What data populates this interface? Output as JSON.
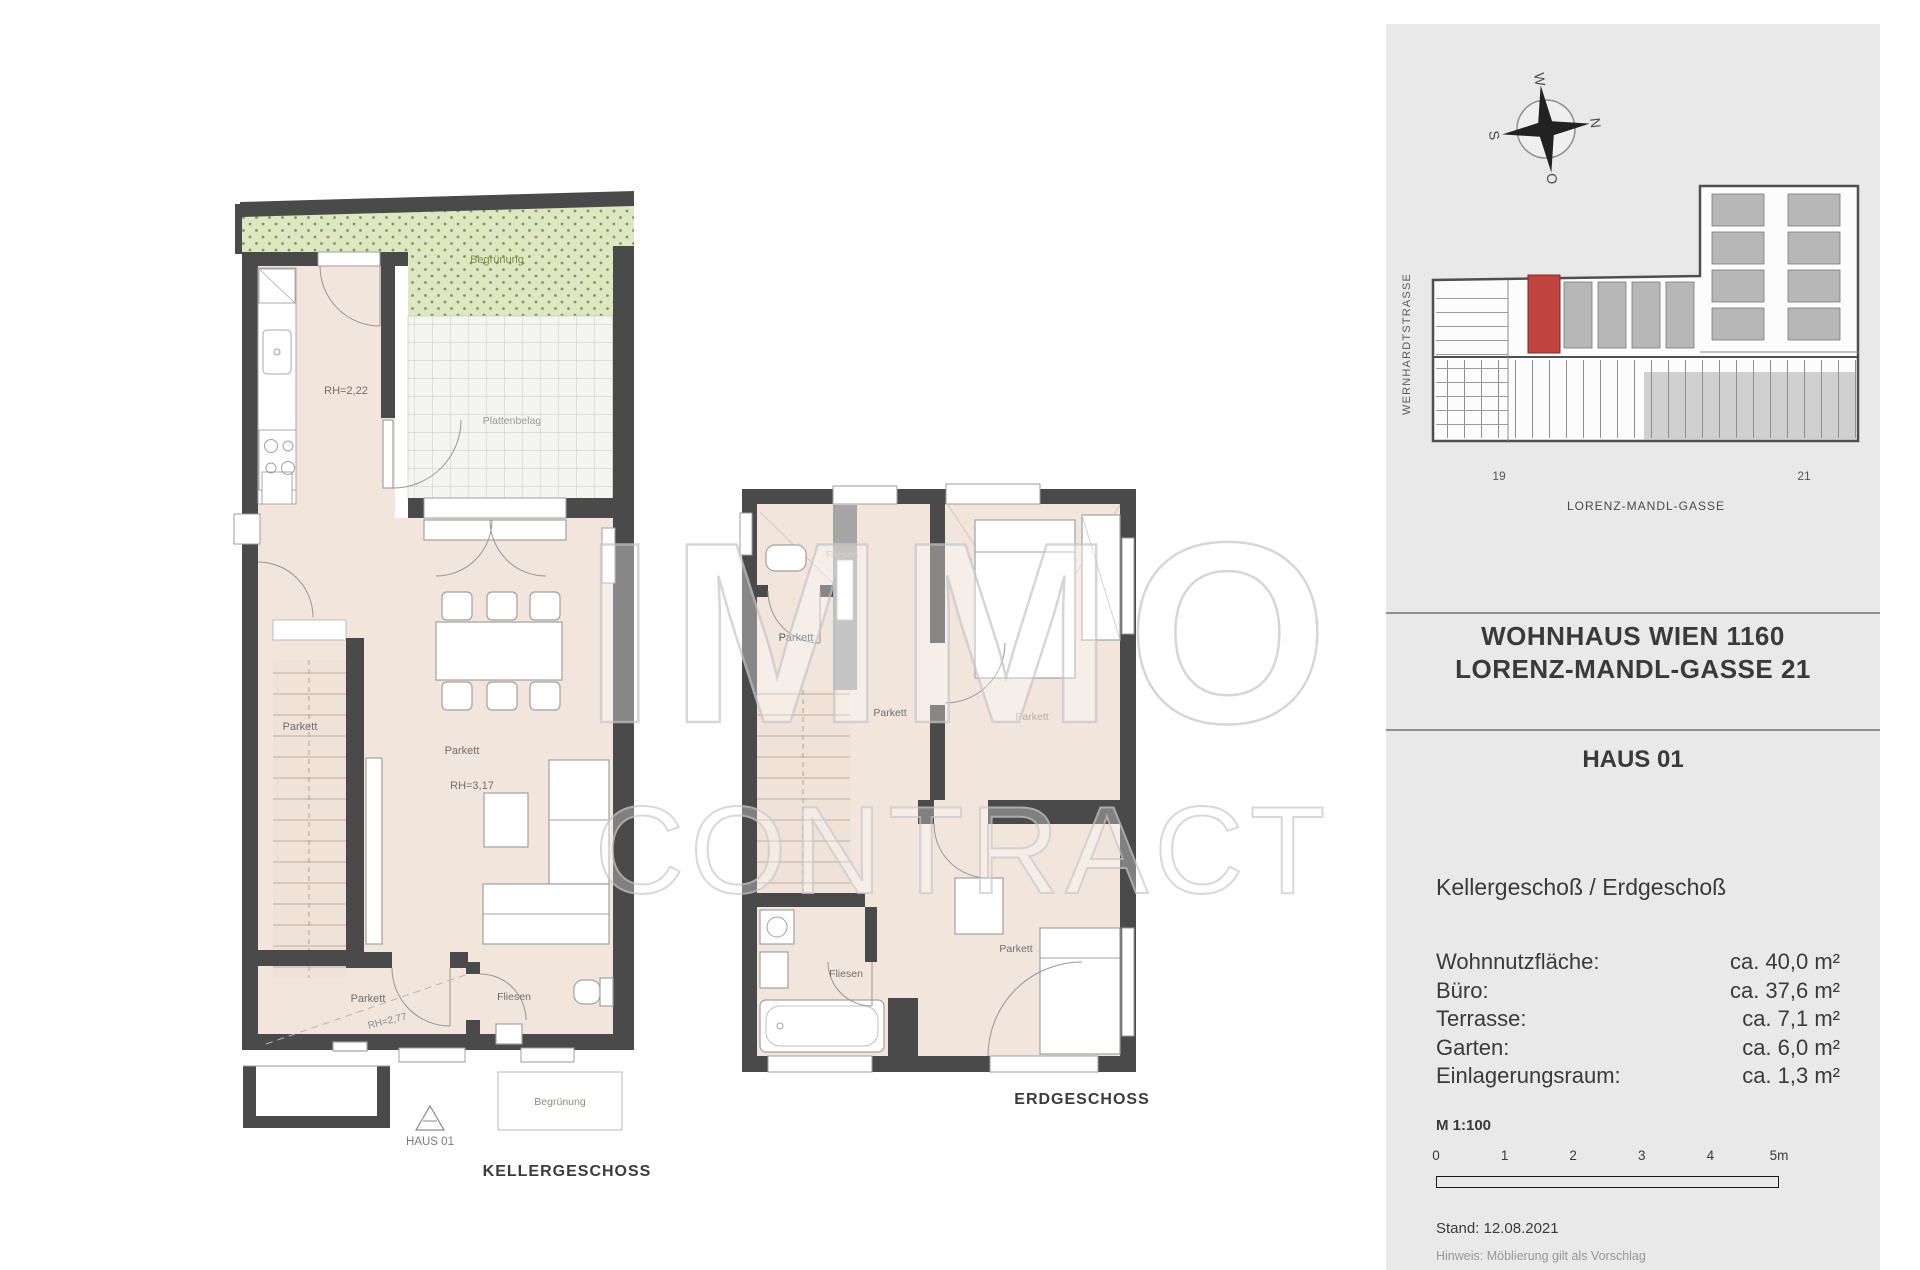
{
  "watermark": {
    "line1": "IMMO",
    "line2": "CONTRACT"
  },
  "plan_kg": {
    "caption": "KELLERGESCHOSS",
    "house_marker": "HAUS 01",
    "labels": {
      "begruenung_top": "Begrünung",
      "plattenbelag": "Plattenbelag",
      "rh_kitchen": "RH=2,22",
      "parkett_stairs": "Parkett",
      "parkett_living": "Parkett",
      "rh_living": "RH=3,17",
      "parkett_corridor": "Parkett",
      "rh_corridor": "RH=2,77",
      "fliesen_bath": "Fliesen",
      "begruenung_bottom": "Begrünung"
    }
  },
  "plan_eg": {
    "caption": "ERDGESCHOSS",
    "labels": {
      "fliesen_wc": "Fliesen",
      "parkett_hall": "Parkett",
      "parkett_corridor": "Parkett",
      "parkett_bedroom": "Parkett",
      "fliesen_bath": "Fliesen",
      "parkett_room2": "Parkett"
    }
  },
  "panel": {
    "compass": {
      "n": "N",
      "e": "O",
      "s": "S",
      "w": "W"
    },
    "siteplan": {
      "street_left": "WERNHARDTSTRASSE",
      "street_bottom": "LORENZ-MANDL-GASSE",
      "house_no_left": "19",
      "house_no_right": "21"
    },
    "title": {
      "line1": "WOHNHAUS WIEN 1160",
      "line2": "LORENZ-MANDL-GASSE 21"
    },
    "unit": "HAUS 01",
    "floors": "Kellergeschoß / Erdgeschoß",
    "areas": {
      "rows": [
        {
          "label": "Wohnnutzfläche:",
          "value": "ca. 40,0 m²"
        },
        {
          "label": "Büro:",
          "value": "ca. 37,6 m²"
        },
        {
          "label": "Terrasse:",
          "value": "ca. 7,1 m²"
        },
        {
          "label": "Garten:",
          "value": "ca. 6,0 m²"
        },
        {
          "label": "Einlagerungsraum:",
          "value": "ca. 1,3 m²"
        }
      ]
    },
    "scale": {
      "label": "M 1:100",
      "ticks": [
        "0",
        "1",
        "2",
        "3",
        "4",
        "5m"
      ]
    },
    "stand": "Stand: 12.08.2021",
    "hinweis": "Hinweis: Möblierung gilt als Vorschlag"
  }
}
